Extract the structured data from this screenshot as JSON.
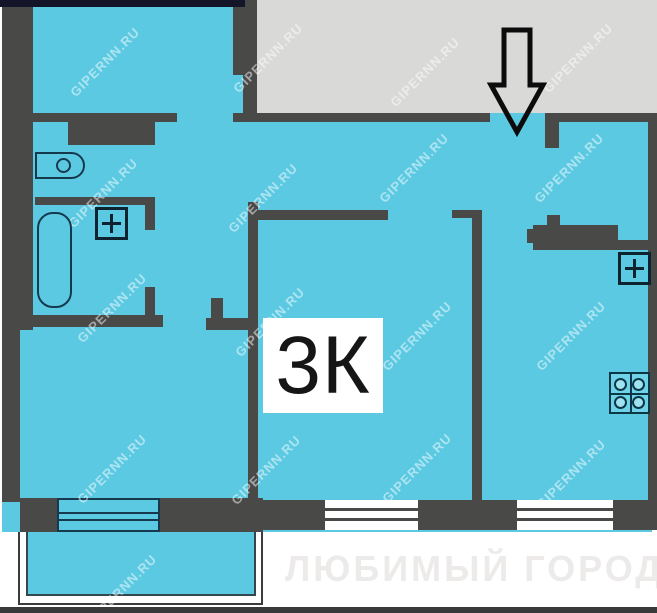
{
  "plan": {
    "room_label": "3К",
    "watermark_text": "GIPERNN.RU",
    "footer_watermark": "ЛЮБИМЫЙ ГОРОД"
  },
  "icons": {
    "entrance": "arrow-down-icon",
    "stove": "stove-burners-icon",
    "toilet": "toilet-icon",
    "bathtub": "bathtub-icon",
    "heater_left": "plus-box-icon",
    "heater_right": "plus-box-icon"
  },
  "colors": {
    "interior": "#5bc9e2",
    "wall": "#494a48",
    "outside": "#d9d9d8",
    "fixture_outline": "#17394e",
    "top_bar": "#15152a"
  }
}
